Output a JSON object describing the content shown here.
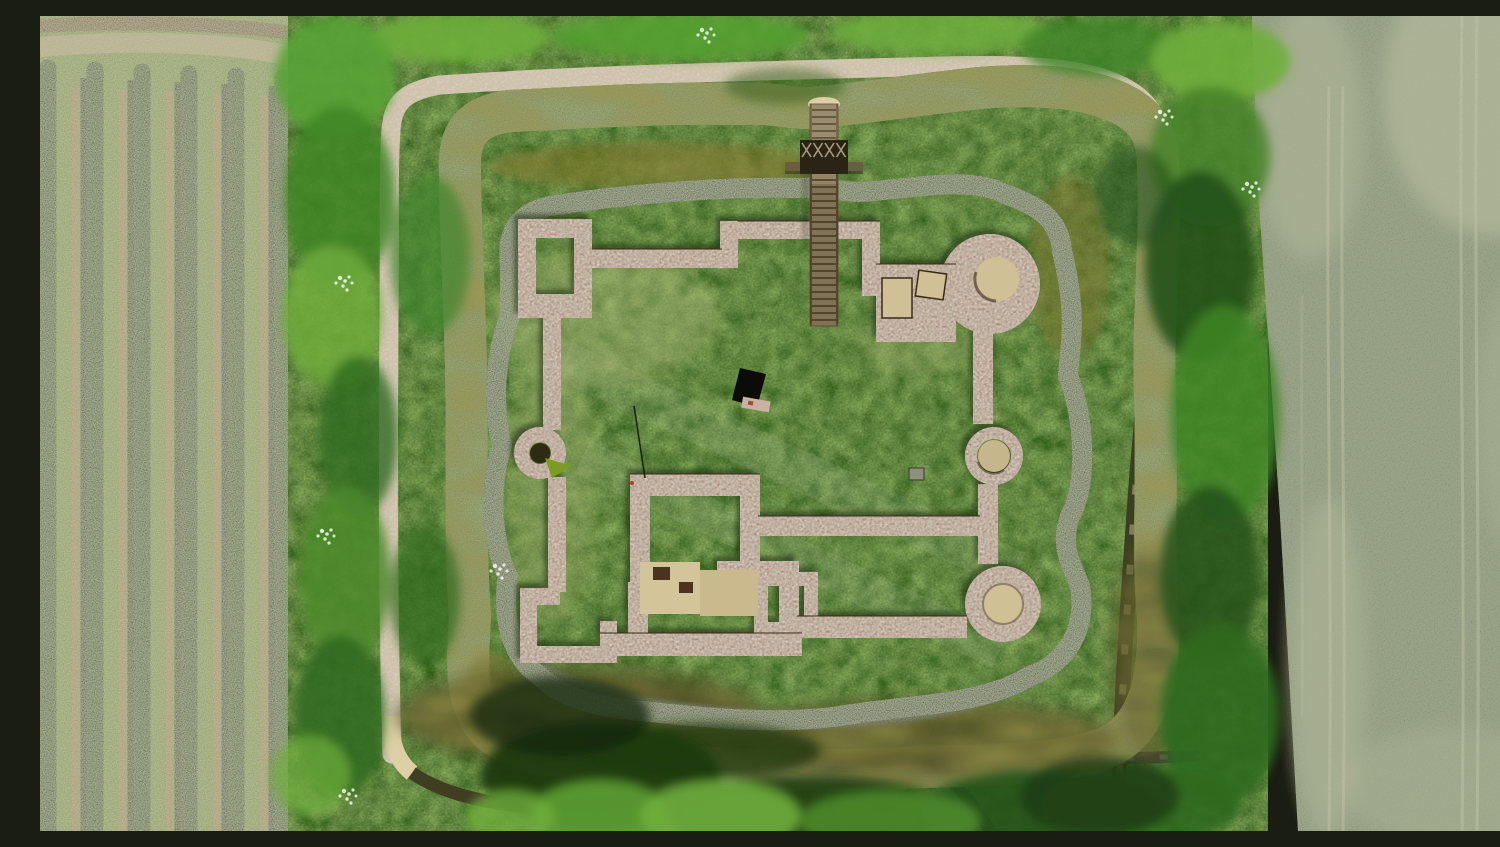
{
  "scene": {
    "type": "aerial-photograph",
    "subject": "Top-down drone photograph of a ruined moated castle: low brick foundation walls and round tower bases on a grassy island inside a dark olive square moat, reached by a wooden footbridge from the north, with an orchard of hedge rows on the left, tree belts and gravel paths surrounding the moat, and a textured green crop field with pale tramlines on the right",
    "regions": {
      "orchard": "Orchard with parallel hedge rows on mown grass",
      "tree_belt": "Belts of trees and shrubs around the moat",
      "crop_field": "Green crop field with pale wheel tramlines",
      "moat": "Dark olive water of the square moat",
      "island": "Grassy castle island inside the moat",
      "castle_ruins": "Low brick foundation walls, round tower bases and gravel floors of the ruined castle",
      "footbridge": "Wooden footbridge crossing the moat from the north",
      "paths": "Gravel and asphalt footpaths around the site",
      "sign": "Dark information panel standing on the lawn"
    },
    "palette": {
      "orchard_grass": "#8fa84b",
      "orchard_row": "#3a6218",
      "orchard_row_shadow": "#1e3c0e",
      "dirt_strip": "#bb9c63",
      "tree_green": "#48842a",
      "tree_light": "#6fae3c",
      "tree_dark": "#1e3a12",
      "reed_bank": "#5a9631",
      "reed_dark": "#24511a",
      "water_top": "#6f6319",
      "water_mid": "#55511d",
      "water_dark": "#23230c",
      "island_grass": "#7b9b23",
      "brick": "#a17a5d",
      "brick_dark": "#5e4229",
      "gravel_floor": "#cfc096",
      "path_gravel": "#ddd0a4",
      "path_asphalt": "#45483a",
      "wood_plank": "#938466",
      "wood_dark": "#2a2416",
      "field_green": "#5e7b4b",
      "field_light": "#d8d5ad",
      "sign_black": "#0b0b08"
    }
  }
}
